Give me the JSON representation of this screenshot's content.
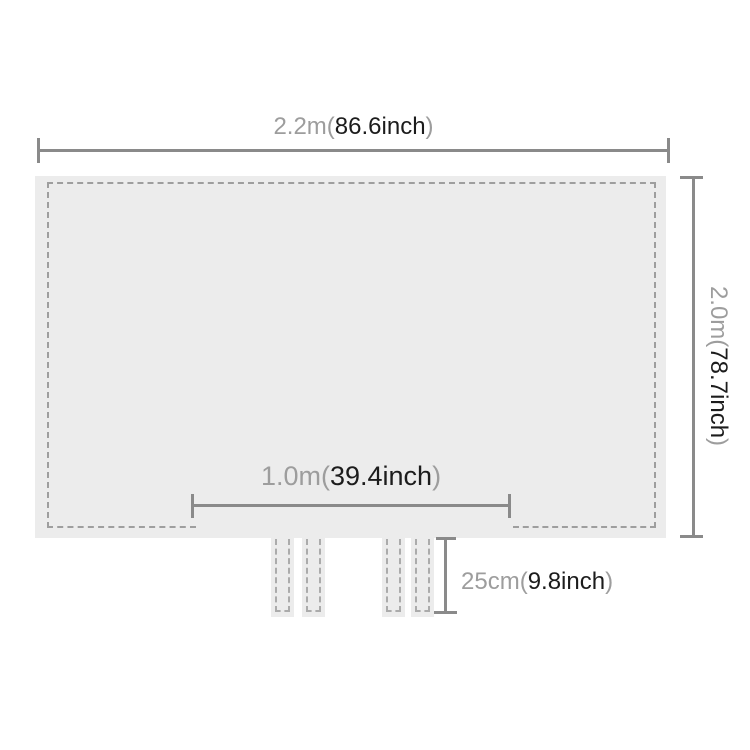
{
  "colors": {
    "background": "#ffffff",
    "sheet_fill": "#ececec",
    "stitch_dash": "#9e9e9e",
    "dimension_line": "#8a8a8a",
    "label_gray": "#9d9d9d",
    "label_dark": "#1c1c1c"
  },
  "dimensions": {
    "width": {
      "metric": "2.2m(",
      "inches": "86.6inch",
      "paren": ")"
    },
    "height": {
      "metric": "2.0m(",
      "inches": "78.7inch",
      "paren": ")"
    },
    "inner_width": {
      "metric": "1.0m(",
      "inches": "39.4inch",
      "paren": ")"
    },
    "strap_length": {
      "metric": "25cm(",
      "inches": "9.8inch",
      "paren": ")"
    }
  }
}
